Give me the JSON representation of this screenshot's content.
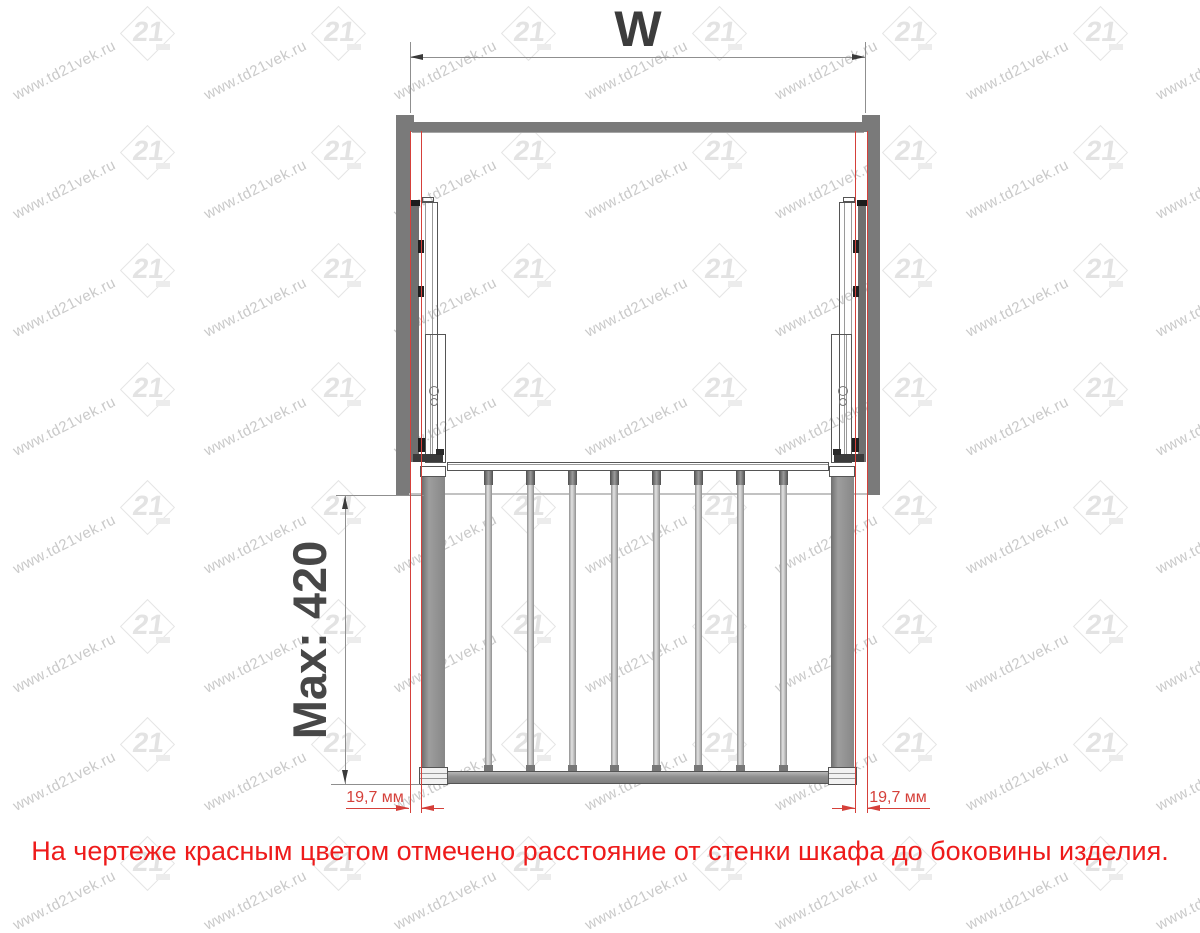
{
  "dimensions": {
    "width_label": "W",
    "max_depth_label": "Max: 420",
    "side_gap_left": "19,7 мм",
    "side_gap_right": "19,7 мм"
  },
  "note": {
    "text": "На чертеже красным цветом отмечено расстояние  от стенки шкафа до боковины изделия."
  },
  "watermark": {
    "text": "www.td21vek.ru",
    "logo_text": "21"
  },
  "drawing": {
    "bars_count": 8
  },
  "colors": {
    "note_red": "#ee1b1b",
    "dimension_red": "#d5403a",
    "metal_gray": "#7a7a7a",
    "line_gray": "#8f8f8f",
    "outline_gray": "#555555",
    "arrow_gray": "#3a3a3a"
  }
}
